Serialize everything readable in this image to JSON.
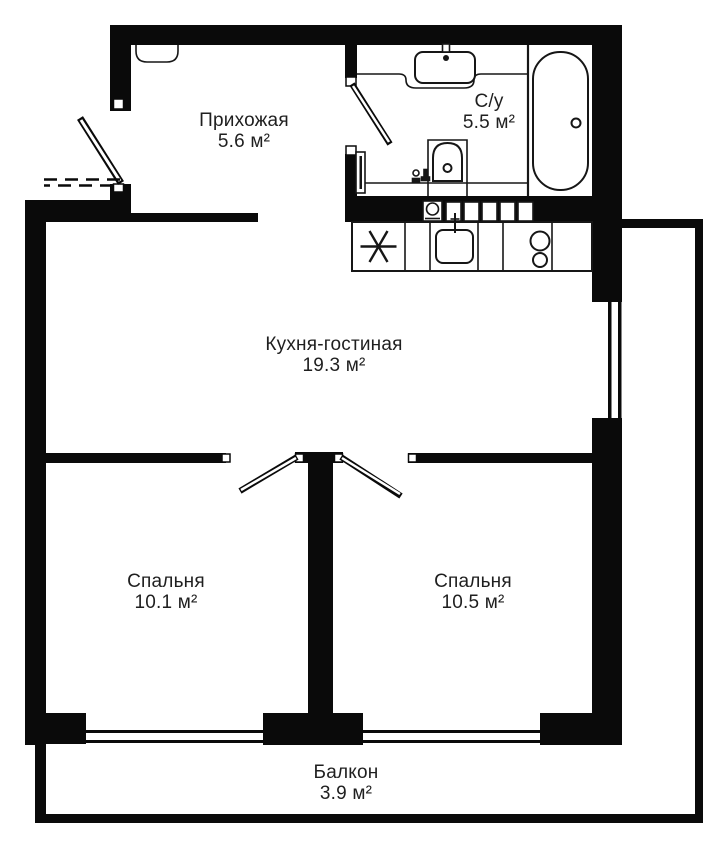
{
  "rooms": {
    "hallway": {
      "name": "Прихожая",
      "area": "5.6 м²"
    },
    "bathroom": {
      "name": "С/у",
      "area": "5.5 м²"
    },
    "kitchen_living": {
      "name": "Кухня-гостиная",
      "area": "19.3 м²"
    },
    "bedroom_left": {
      "name": "Спальня",
      "area": "10.1 м²"
    },
    "bedroom_right": {
      "name": "Спальня",
      "area": "10.5 м²"
    },
    "balcony": {
      "name": "Балкон",
      "area": "3.9 м²"
    }
  },
  "colors": {
    "wall": "#0a0a0a",
    "fixture_line": "#161616",
    "text": "#1f1f1f",
    "background": "#ffffff"
  }
}
